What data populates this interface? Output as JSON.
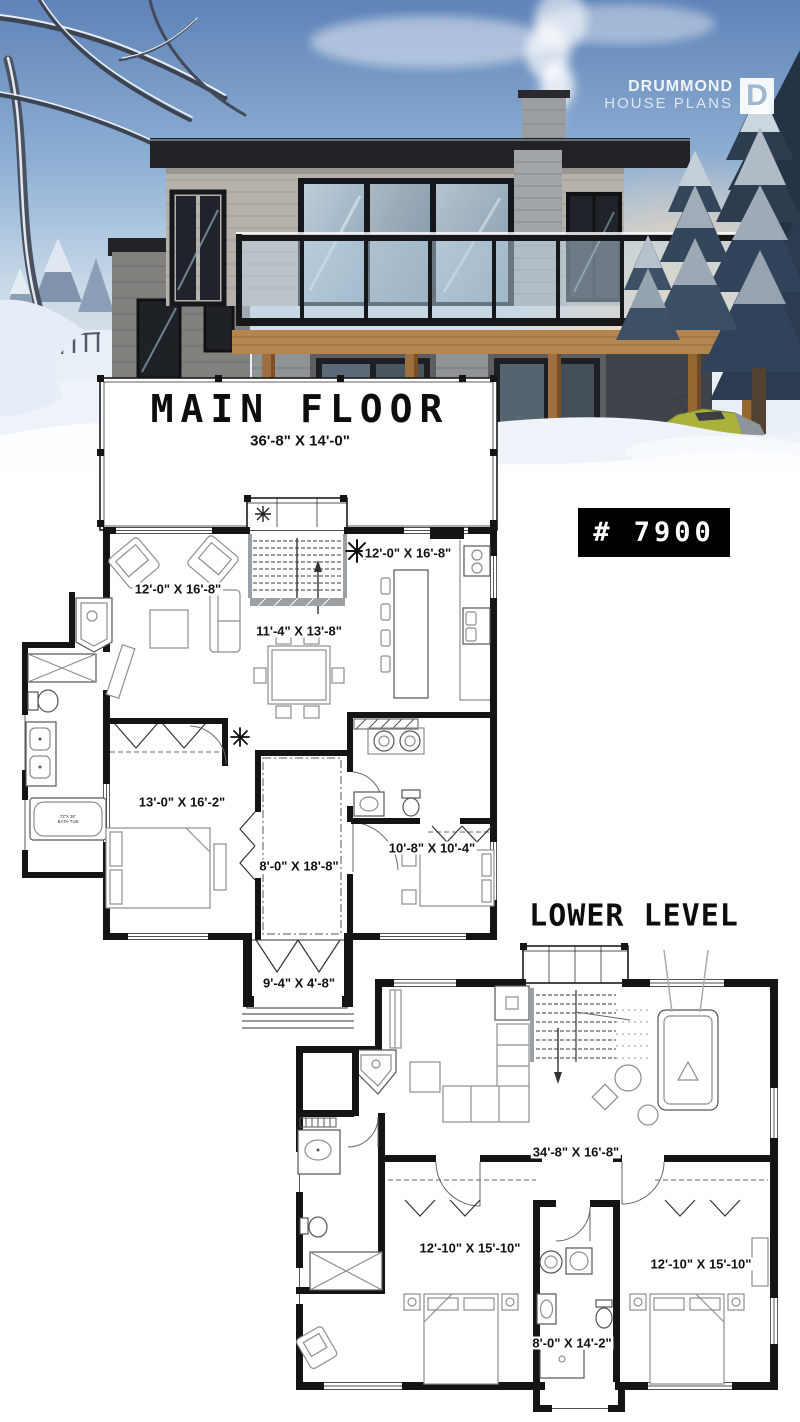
{
  "brand": {
    "line1": "DRUMMOND",
    "line2": "HOUSE PLANS",
    "monogram": "D"
  },
  "plan_number": {
    "label": "# 7900"
  },
  "main_floor": {
    "title": "MAIN FLOOR",
    "overall_dimensions": "36'-8\" X 14'-0\"",
    "rooms": [
      {
        "name": "living-room",
        "dimensions": "12'-0\" X 16'-8\""
      },
      {
        "name": "kitchen",
        "dimensions": "12'-0\" X 16'-8\""
      },
      {
        "name": "dining-room",
        "dimensions": "11'-4\" X 13'-8\""
      },
      {
        "name": "master-bedroom",
        "dimensions": "13'-0\" X 16'-2\""
      },
      {
        "name": "covered-porch",
        "dimensions": "8'-0\" X 18'-8\""
      },
      {
        "name": "bedroom-2",
        "dimensions": "10'-8\" X 10'-4\""
      },
      {
        "name": "front-porch",
        "dimensions": "9'-4\" X 4'-8\""
      }
    ],
    "bathtub_line1": "72\"X 36\"",
    "bathtub_line2": "BATH-TUB"
  },
  "lower_level": {
    "title": "LOWER LEVEL",
    "rooms": [
      {
        "name": "family-room",
        "dimensions": "34'-8\" X 16'-8\""
      },
      {
        "name": "bedroom-3",
        "dimensions": "12'-10\" X 15'-10\""
      },
      {
        "name": "bedroom-4",
        "dimensions": "12'-10\" X 15'-10\""
      },
      {
        "name": "bathroom",
        "dimensions": "8'-0\" X 14'-2\""
      }
    ]
  },
  "colors": {
    "badge_background": "#000000",
    "badge_text": "#ffffff",
    "plan_wall": "#141414",
    "deck_wood": "#b5854f",
    "sky": "#5f83b8"
  }
}
